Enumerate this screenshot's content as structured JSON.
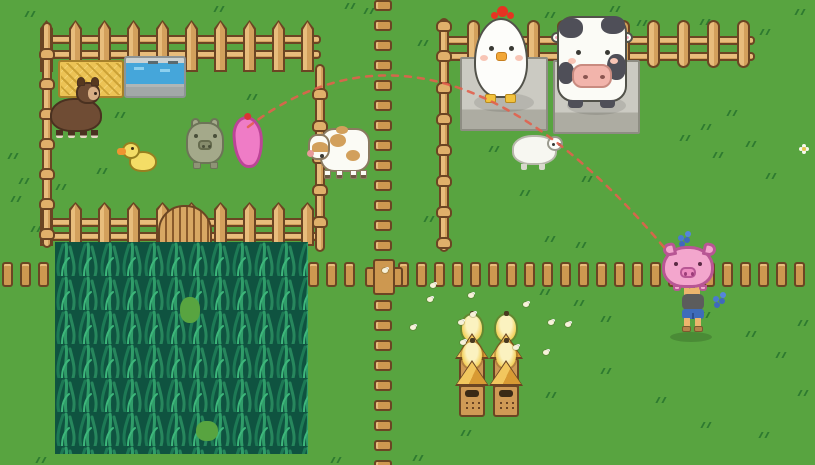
{
  "meta": {
    "app": "pixel-art farm game",
    "view": "top-down farm scene",
    "canvas": {
      "width": 815,
      "height": 465
    },
    "visible_text": "none"
  },
  "palette": {
    "grass": "#58a440",
    "grass_tuft": "#2e7a30",
    "wood": "#d3a05c",
    "wood_light": "#e8bd7c",
    "wood_outline": "#6b4523",
    "stone": "#cbcac2",
    "water": "#45a6da",
    "hay": "#ecc355",
    "corn_dark": "#0f5340",
    "corn_blade": "#2f9d69",
    "trajectory_red": "#e2604d",
    "pig_pink": "#f3a6cd",
    "ghost_pig_pink": "#ef7cc6",
    "hive_gold": "#f2c75e",
    "chicken_white": "#fdfdfa",
    "cow_patch": "#4f4f58",
    "alpaca_brown": "#6f4c34",
    "duck_yellow": "#f4dd66",
    "flower_blue": "#4a7ad0"
  },
  "scene": {
    "labels": {
      "scene": "top-down pixel farm with animal pen, pastures, corn field and beehives",
      "chicken": "giant chicken on stone stand",
      "holstein_cow": "dairy cow on stone stand",
      "brown_cow": "brown-spotted cow",
      "sheep": "resting sheep",
      "alpaca": "brown alpaca",
      "duckling": "yellow duckling",
      "green_pig": "green pig",
      "ghost_pig": "pig landing preview marker",
      "player": "farmer holding a pig overhead",
      "beehives": "stack of four beehives",
      "corn_field": "planted corn field",
      "hay_bale": "hay feeder",
      "water_trough": "water trough",
      "gate": "pen gate",
      "trajectory": "dashed throw trajectory"
    },
    "trajectory": {
      "path": "M248,127 Q440,-20 668,252",
      "color": "#e2604d",
      "style": "dashed"
    },
    "fences": {
      "rails": [
        [
          44,
          35,
          277
        ],
        [
          44,
          50,
          277
        ],
        [
          44,
          218,
          277
        ],
        [
          44,
          232,
          277
        ],
        [
          443,
          36,
          312
        ],
        [
          443,
          52,
          312
        ]
      ],
      "picket_rows": [
        {
          "x": 40,
          "y": 20,
          "n": 10,
          "pitch": 29,
          "h": 52
        },
        {
          "x": 40,
          "y": 202,
          "n": 10,
          "pitch": 29,
          "h": 44
        }
      ],
      "poles": [
        {
          "x": 42,
          "y0": 22,
          "y1": 248,
          "knobs": [
            48,
            78,
            108,
            138,
            168,
            198,
            228
          ]
        },
        {
          "x": 315,
          "y0": 64,
          "y1": 252,
          "knobs": [
            88,
            120,
            152,
            184,
            216
          ]
        },
        {
          "x": 439,
          "y0": 18,
          "y1": 252,
          "knobs": [
            20,
            50,
            82,
            113,
            144,
            175,
            206,
            237
          ]
        }
      ],
      "posts": {
        "x0": 467,
        "y": 20,
        "n": 10,
        "pitch": 30
      },
      "plank_row": {
        "y": 262,
        "x0": 2,
        "n": 45,
        "pitch": 18,
        "skip": [
          20,
          21
        ]
      },
      "plank_col": {
        "x": 374,
        "y0": 0,
        "n": 24,
        "pitch": 20,
        "skip": [
          13,
          14
        ]
      }
    },
    "decor": {
      "grass_tufts": [
        [
          25,
          11
        ],
        [
          214,
          6
        ],
        [
          345,
          3
        ],
        [
          303,
          29
        ],
        [
          364,
          8
        ],
        [
          418,
          40
        ],
        [
          545,
          12
        ],
        [
          610,
          6
        ],
        [
          637,
          20
        ],
        [
          700,
          19
        ],
        [
          760,
          29
        ],
        [
          795,
          9
        ],
        [
          115,
          112
        ],
        [
          247,
          94
        ],
        [
          202,
          141
        ],
        [
          97,
          168
        ],
        [
          56,
          184
        ],
        [
          8,
          153
        ],
        [
          19,
          178
        ],
        [
          11,
          196
        ],
        [
          31,
          226
        ],
        [
          152,
          232
        ],
        [
          489,
          146
        ],
        [
          520,
          190
        ],
        [
          424,
          216
        ],
        [
          545,
          236
        ],
        [
          576,
          242
        ],
        [
          582,
          176
        ],
        [
          680,
          135
        ],
        [
          701,
          124
        ],
        [
          713,
          152
        ],
        [
          727,
          110
        ],
        [
          746,
          141
        ],
        [
          766,
          173
        ],
        [
          540,
          289
        ],
        [
          574,
          300
        ],
        [
          601,
          316
        ],
        [
          700,
          312
        ],
        [
          746,
          331
        ],
        [
          776,
          352
        ],
        [
          798,
          320
        ],
        [
          546,
          392
        ],
        [
          601,
          368
        ],
        [
          656,
          397
        ],
        [
          701,
          422
        ],
        [
          759,
          432
        ],
        [
          798,
          390
        ],
        [
          413,
          455
        ],
        [
          331,
          457
        ],
        [
          36,
          457
        ],
        [
          461,
          430
        ]
      ],
      "bees": [
        [
          427,
          297
        ],
        [
          468,
          293
        ],
        [
          410,
          325
        ],
        [
          458,
          320
        ],
        [
          470,
          312
        ],
        [
          513,
          345
        ],
        [
          543,
          350
        ],
        [
          565,
          322
        ],
        [
          548,
          320
        ],
        [
          460,
          340
        ],
        [
          523,
          302
        ],
        [
          430,
          283
        ],
        [
          382,
          268
        ]
      ],
      "flowers": {
        "white": [
          [
            799,
            144
          ]
        ],
        "blue": [
          [
            677,
            233
          ],
          [
            712,
            294
          ]
        ]
      }
    },
    "counts": {
      "beehives": 4,
      "animals": 8,
      "bees": 13
    }
  }
}
